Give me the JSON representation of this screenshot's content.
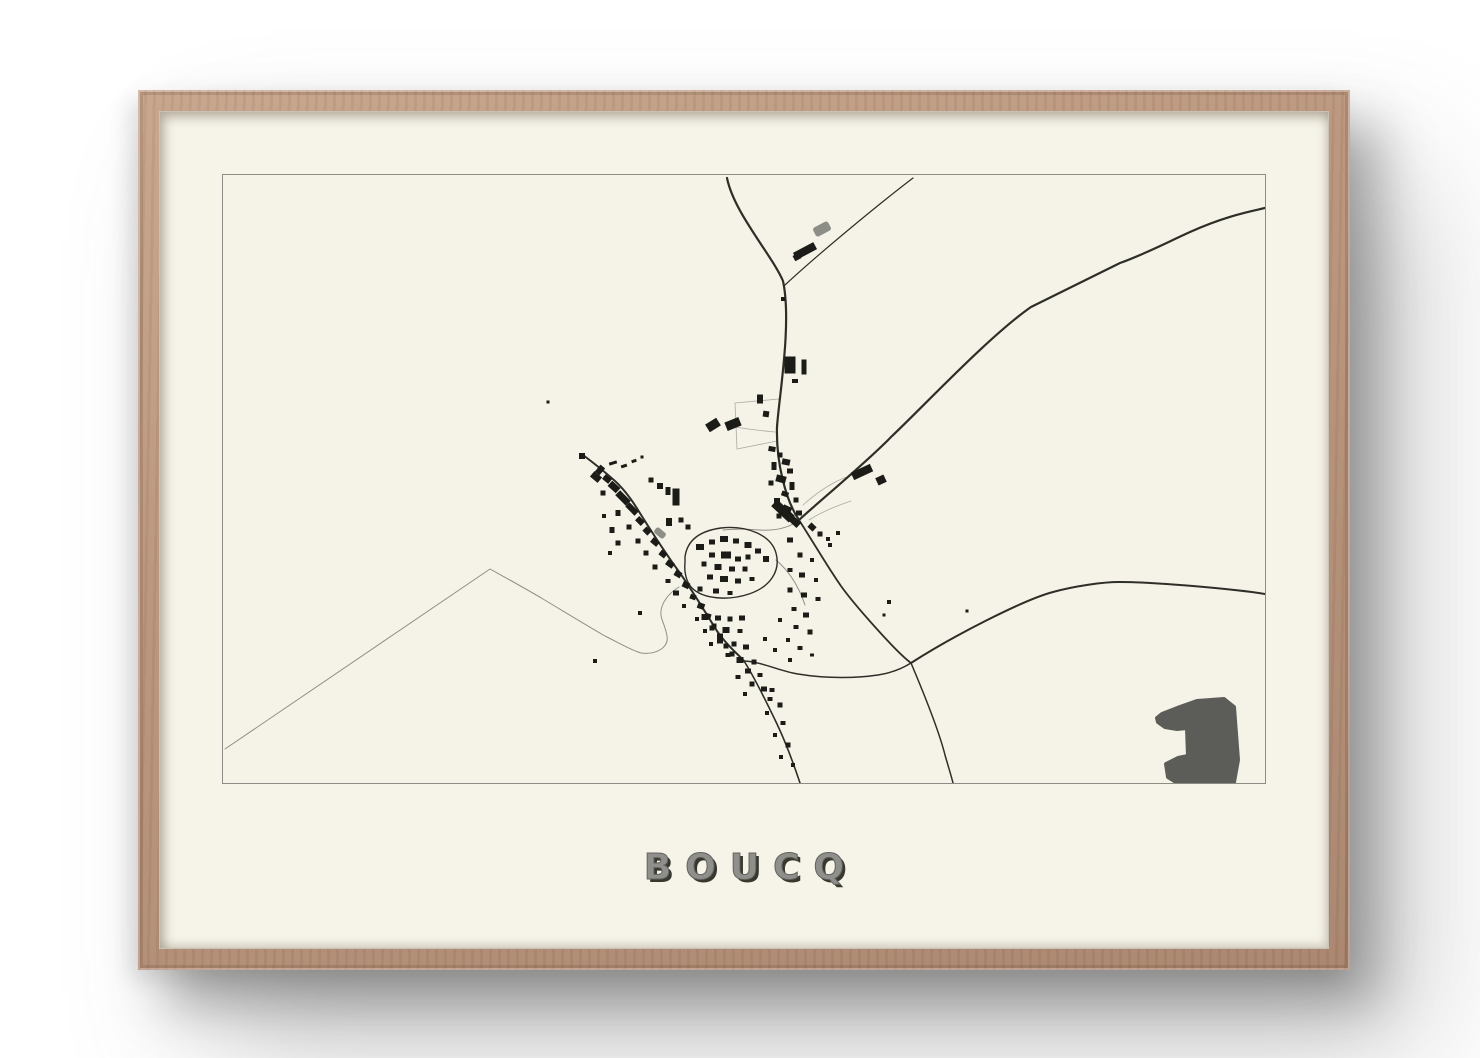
{
  "poster": {
    "title": "BOUCQ",
    "title_color": "#8f8f8b",
    "title_shadow_color": "#38382f",
    "frame_wood_color": "#b8957e",
    "paper_color": "#f6f4e9",
    "wall_color": "#ffffff"
  },
  "map": {
    "viewbox": "0 0 1042 608",
    "border_color": "#8d8d87",
    "road_color": "#2e2e29",
    "lane_color": "#8f8f88",
    "field_color": "#aaaaa2",
    "building_color": "#1b1b17",
    "gray_feature_color": "#8e8e88",
    "forest_color": "#5c5c58",
    "roads": [
      {
        "name": "north-main-road",
        "d": "M504,3 C511,38 549,80 560,106 C569,148 556,222 554,252 C553,288 563,326 576,345",
        "w": 2.2
      },
      {
        "name": "northeast-lane",
        "d": "M562,110 C592,82 652,32 690,3",
        "w": 1.2
      },
      {
        "name": "northeast-diagonal-road",
        "d": "M1042,33 C1030,36 1005,40 967,57 C947,66 920,80 897,88 L808,132 C765,162 700,232 668,262 C645,286 592,330 576,345",
        "w": 2.2
      },
      {
        "name": "village-to-junction-road",
        "d": "M576,345 C592,370 606,394 618,411 C630,428 672,476 688,488",
        "w": 1.8
      },
      {
        "name": "east-road",
        "d": "M688,488 C730,461 800,425 830,417 C852,411 880,407 896,407 C932,407 1012,414 1042,419",
        "w": 2.0
      },
      {
        "name": "south-road",
        "d": "M688,488 C699,514 716,556 722,580 C726,594 728,600 730,608",
        "w": 1.5
      },
      {
        "name": "west-link-road",
        "d": "M521,486 C540,487 556,496 575,499 C605,504 635,503 655,500 C668,498 680,493 688,488",
        "w": 1.5
      },
      {
        "name": "southwest-exit-road",
        "d": "M521,486 C530,500 543,526 554,549 C564,570 572,593 577,608",
        "w": 1.6
      },
      {
        "name": "main-street",
        "d": "M360,280 C372,289 382,297 392,306 C404,317 412,330 420,343 C432,362 444,380 454,394 C466,410 484,440 494,456 C505,472 514,478 521,486",
        "w": 2.0
      },
      {
        "name": "village-loop",
        "d": "M462,382 C464,366 476,356 498,353 C524,350 548,360 553,378 C558,396 547,412 526,419 C505,426 480,424 469,413 C463,407 461,396 462,388 Z",
        "w": 1.4
      }
    ],
    "lanes": [
      {
        "name": "southwest-long-lane",
        "d": "M2,574 L267,394 C285,404 305,415 320,424 C345,439 368,453 382,461 C398,469 410,476 418,478 C434,480 446,472 444,461 C442,449 437,444 438,436 C439,427 446,418 456,412",
        "w": 1.0
      },
      {
        "name": "loop-east-spur",
        "d": "M553,385 C566,396 576,412 582,430",
        "w": 1.0
      },
      {
        "name": "north-village-lane",
        "d": "M576,345 C566,353 552,356 536,355 C524,354 510,354 500,355",
        "w": 1.0
      }
    ],
    "field_lines": [
      {
        "name": "field-enclosure",
        "d": "M512,228 L556,224 L554,266 L514,274 Z",
        "w": 0.8
      },
      {
        "name": "field-line-a",
        "d": "M512,252 C530,255 542,256 552,257",
        "w": 0.8
      },
      {
        "name": "field-line-b",
        "d": "M580,330 C600,312 618,303 630,300",
        "w": 0.8
      },
      {
        "name": "field-line-c",
        "d": "M586,345 C600,336 616,330 628,326",
        "w": 0.8
      }
    ],
    "buildings": [
      [
        567,
        190,
        11,
        17,
        0
      ],
      [
        581,
        192,
        5,
        15,
        0
      ],
      [
        572,
        206,
        6,
        4,
        0
      ],
      [
        560,
        124,
        4,
        4,
        0
      ],
      [
        582,
        76,
        23,
        8,
        -28
      ],
      [
        574,
        82,
        7,
        6,
        -28
      ],
      [
        510,
        249,
        15,
        9,
        -22
      ],
      [
        490,
        250,
        13,
        9,
        -32
      ],
      [
        537,
        224,
        6,
        9,
        0
      ],
      [
        543,
        239,
        6,
        6,
        8
      ],
      [
        325,
        227,
        3,
        3,
        0
      ],
      [
        417,
        438,
        4,
        4,
        0
      ],
      [
        372,
        486,
        4,
        4,
        0
      ],
      [
        666,
        427,
        4,
        4,
        0
      ],
      [
        661,
        440,
        3,
        3,
        0
      ],
      [
        744,
        436,
        3,
        3,
        0
      ],
      [
        549,
        274,
        7,
        5,
        10
      ],
      [
        557,
        280,
        5,
        5,
        0
      ],
      [
        563,
        287,
        8,
        6,
        12
      ],
      [
        551,
        291,
        5,
        8,
        0
      ],
      [
        567,
        296,
        6,
        5,
        0
      ],
      [
        558,
        304,
        10,
        7,
        15
      ],
      [
        548,
        308,
        5,
        5,
        0
      ],
      [
        569,
        311,
        5,
        8,
        0
      ],
      [
        562,
        319,
        7,
        5,
        20
      ],
      [
        554,
        326,
        6,
        6,
        0
      ],
      [
        573,
        325,
        5,
        5,
        0
      ],
      [
        564,
        334,
        9,
        6,
        25
      ],
      [
        576,
        338,
        6,
        5,
        0
      ],
      [
        556,
        341,
        5,
        5,
        0
      ],
      [
        560,
        336,
        24,
        9,
        43
      ],
      [
        570,
        345,
        16,
        7,
        43
      ],
      [
        589,
        352,
        7,
        6,
        43
      ],
      [
        597,
        359,
        5,
        5,
        0
      ],
      [
        605,
        364,
        4,
        4,
        0
      ],
      [
        639,
        297,
        21,
        8,
        -25
      ],
      [
        658,
        305,
        9,
        8,
        -25
      ],
      [
        615,
        358,
        4,
        4,
        0
      ],
      [
        607,
        370,
        4,
        4,
        0
      ],
      [
        390,
        288,
        8,
        3,
        -18
      ],
      [
        401,
        291,
        6,
        3,
        -18
      ],
      [
        411,
        286,
        5,
        3,
        -18
      ],
      [
        419,
        282,
        3,
        3,
        0
      ],
      [
        359,
        281,
        6,
        6,
        0
      ],
      [
        373,
        302,
        10,
        7,
        40
      ],
      [
        377,
        295,
        6,
        9,
        40
      ],
      [
        384,
        304,
        8,
        6,
        40
      ],
      [
        391,
        312,
        11,
        7,
        42
      ],
      [
        380,
        318,
        5,
        5,
        0
      ],
      [
        400,
        323,
        15,
        7,
        45
      ],
      [
        409,
        334,
        13,
        6,
        45
      ],
      [
        395,
        338,
        5,
        6,
        0
      ],
      [
        417,
        346,
        8,
        6,
        45
      ],
      [
        406,
        352,
        5,
        5,
        0
      ],
      [
        424,
        356,
        7,
        6,
        45
      ],
      [
        415,
        366,
        5,
        5,
        0
      ],
      [
        432,
        367,
        8,
        6,
        40
      ],
      [
        423,
        378,
        5,
        5,
        0
      ],
      [
        440,
        379,
        7,
        6,
        38
      ],
      [
        447,
        389,
        8,
        6,
        35
      ],
      [
        432,
        392,
        5,
        5,
        0
      ],
      [
        455,
        399,
        7,
        6,
        30
      ],
      [
        445,
        406,
        5,
        4,
        0
      ],
      [
        463,
        410,
        7,
        6,
        25
      ],
      [
        453,
        418,
        6,
        5,
        0
      ],
      [
        470,
        422,
        6,
        5,
        20
      ],
      [
        478,
        431,
        7,
        6,
        20
      ],
      [
        461,
        431,
        4,
        4,
        0
      ],
      [
        485,
        441,
        6,
        5,
        15
      ],
      [
        474,
        444,
        4,
        4,
        0
      ],
      [
        491,
        451,
        5,
        5,
        0
      ],
      [
        482,
        456,
        4,
        4,
        0
      ],
      [
        497,
        461,
        6,
        5,
        0
      ],
      [
        488,
        469,
        4,
        4,
        0
      ],
      [
        503,
        471,
        5,
        5,
        0
      ],
      [
        509,
        479,
        5,
        5,
        0
      ],
      [
        389,
        355,
        5,
        6,
        0
      ],
      [
        395,
        368,
        5,
        5,
        0
      ],
      [
        387,
        378,
        4,
        4,
        0
      ],
      [
        381,
        341,
        4,
        4,
        0
      ],
      [
        453,
        322,
        7,
        17,
        0
      ],
      [
        445,
        316,
        5,
        8,
        0
      ],
      [
        437,
        311,
        6,
        6,
        0
      ],
      [
        428,
        305,
        5,
        5,
        0
      ],
      [
        458,
        345,
        5,
        5,
        0
      ],
      [
        446,
        347,
        6,
        8,
        0
      ],
      [
        465,
        352,
        5,
        5,
        0
      ],
      [
        477,
        372,
        8,
        6,
        0
      ],
      [
        489,
        367,
        6,
        5,
        0
      ],
      [
        501,
        364,
        8,
        6,
        0
      ],
      [
        513,
        366,
        6,
        5,
        0
      ],
      [
        525,
        370,
        7,
        6,
        0
      ],
      [
        535,
        376,
        6,
        5,
        0
      ],
      [
        543,
        384,
        6,
        6,
        0
      ],
      [
        525,
        382,
        5,
        5,
        0
      ],
      [
        489,
        380,
        6,
        5,
        0
      ],
      [
        503,
        380,
        10,
        7,
        0
      ],
      [
        515,
        384,
        6,
        5,
        0
      ],
      [
        481,
        389,
        5,
        5,
        0
      ],
      [
        495,
        392,
        7,
        6,
        0
      ],
      [
        509,
        394,
        6,
        5,
        0
      ],
      [
        522,
        394,
        5,
        5,
        0
      ],
      [
        487,
        402,
        6,
        5,
        0
      ],
      [
        501,
        404,
        8,
        6,
        0
      ],
      [
        515,
        406,
        6,
        5,
        0
      ],
      [
        529,
        404,
        5,
        4,
        0
      ],
      [
        477,
        414,
        5,
        5,
        0
      ],
      [
        493,
        416,
        6,
        5,
        0
      ],
      [
        507,
        418,
        5,
        4,
        0
      ],
      [
        482,
        442,
        7,
        6,
        0
      ],
      [
        495,
        443,
        6,
        5,
        0
      ],
      [
        507,
        444,
        5,
        5,
        0
      ],
      [
        519,
        443,
        6,
        5,
        0
      ],
      [
        489,
        453,
        5,
        5,
        0
      ],
      [
        503,
        455,
        7,
        6,
        0
      ],
      [
        517,
        456,
        5,
        4,
        0
      ],
      [
        497,
        466,
        6,
        5,
        0
      ],
      [
        511,
        469,
        5,
        5,
        0
      ],
      [
        523,
        472,
        6,
        5,
        0
      ],
      [
        505,
        480,
        5,
        4,
        0
      ],
      [
        517,
        485,
        7,
        6,
        0
      ],
      [
        531,
        487,
        5,
        5,
        0
      ],
      [
        525,
        496,
        6,
        5,
        0
      ],
      [
        537,
        500,
        5,
        4,
        0
      ],
      [
        515,
        502,
        5,
        4,
        0
      ],
      [
        529,
        509,
        5,
        5,
        0
      ],
      [
        541,
        514,
        6,
        5,
        0
      ],
      [
        522,
        519,
        4,
        4,
        0
      ],
      [
        547,
        524,
        5,
        4,
        0
      ],
      [
        567,
        365,
        6,
        5,
        0
      ],
      [
        577,
        380,
        5,
        5,
        0
      ],
      [
        589,
        385,
        4,
        4,
        0
      ],
      [
        567,
        395,
        5,
        4,
        0
      ],
      [
        579,
        400,
        6,
        5,
        0
      ],
      [
        593,
        405,
        4,
        4,
        0
      ],
      [
        567,
        415,
        5,
        5,
        0
      ],
      [
        581,
        420,
        6,
        5,
        0
      ],
      [
        595,
        424,
        5,
        4,
        0
      ],
      [
        571,
        434,
        5,
        4,
        0
      ],
      [
        583,
        440,
        6,
        5,
        0
      ],
      [
        557,
        445,
        4,
        4,
        0
      ],
      [
        573,
        452,
        5,
        4,
        0
      ],
      [
        587,
        457,
        5,
        5,
        0
      ],
      [
        565,
        465,
        4,
        4,
        0
      ],
      [
        577,
        473,
        5,
        4,
        0
      ],
      [
        552,
        475,
        4,
        4,
        0
      ],
      [
        589,
        480,
        4,
        3,
        0
      ],
      [
        567,
        485,
        4,
        4,
        0
      ],
      [
        542,
        464,
        4,
        4,
        0
      ],
      [
        549,
        515,
        5,
        4,
        0
      ],
      [
        557,
        530,
        5,
        5,
        0
      ],
      [
        544,
        538,
        4,
        4,
        0
      ],
      [
        560,
        548,
        5,
        4,
        0
      ],
      [
        552,
        560,
        4,
        4,
        0
      ],
      [
        565,
        570,
        5,
        5,
        0
      ],
      [
        558,
        582,
        4,
        4,
        0
      ],
      [
        570,
        590,
        4,
        4,
        0
      ]
    ],
    "gray_buildings": [
      [
        599,
        54,
        17,
        10,
        -28
      ],
      [
        437,
        358,
        12,
        7,
        40
      ]
    ],
    "forest_blob": {
      "points": "974,526 1001,524 1011,532 1015,585 1011,607 953,607 945,602 943,589 955,583 965,581 964,553 954,554 942,552 935,547 934,543 939,539 957,532"
    }
  }
}
